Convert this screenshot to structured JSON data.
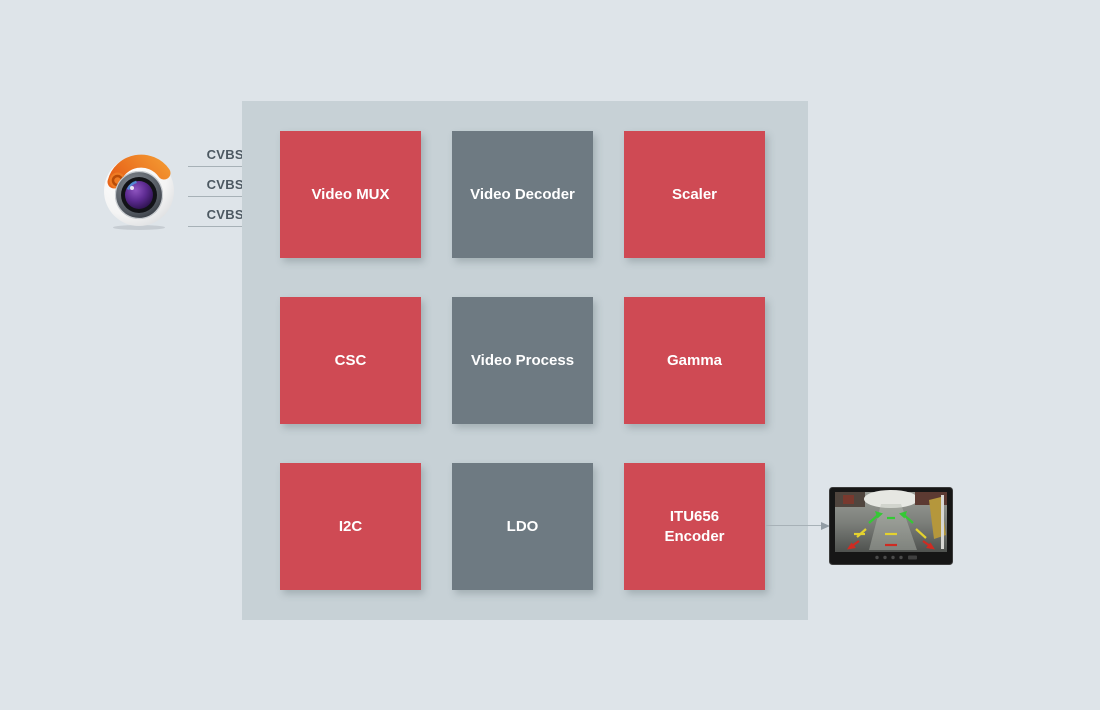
{
  "page": {
    "background_color": "#dee4e9"
  },
  "diagram": {
    "container": {
      "background_color": "#c7d1d6"
    },
    "source": {
      "icon": "camera-icon"
    },
    "inputs": [
      {
        "label": "CVBS0"
      },
      {
        "label": "CVBS1"
      },
      {
        "label": "CVBS2"
      }
    ],
    "blocks": [
      {
        "label": "Video MUX",
        "variant": "red",
        "color": "#cf4a54"
      },
      {
        "label": "Video Decoder",
        "variant": "gray",
        "color": "#6e7a82"
      },
      {
        "label": "Scaler",
        "variant": "red",
        "color": "#cf4a54"
      },
      {
        "label": "CSC",
        "variant": "red",
        "color": "#cf4a54"
      },
      {
        "label": "Video Process",
        "variant": "gray",
        "color": "#6e7a82"
      },
      {
        "label": "Gamma",
        "variant": "red",
        "color": "#cf4a54"
      },
      {
        "label": "I2C",
        "variant": "red",
        "color": "#cf4a54"
      },
      {
        "label": "LDO",
        "variant": "gray",
        "color": "#6e7a82"
      },
      {
        "label": "ITU656 Encoder",
        "variant": "red",
        "color": "#cf4a54"
      }
    ],
    "output": {
      "icon": "monitor-icon"
    },
    "guideline_colors": {
      "near": "#cf2b22",
      "mid": "#e4d22e",
      "far": "#35c935"
    }
  }
}
